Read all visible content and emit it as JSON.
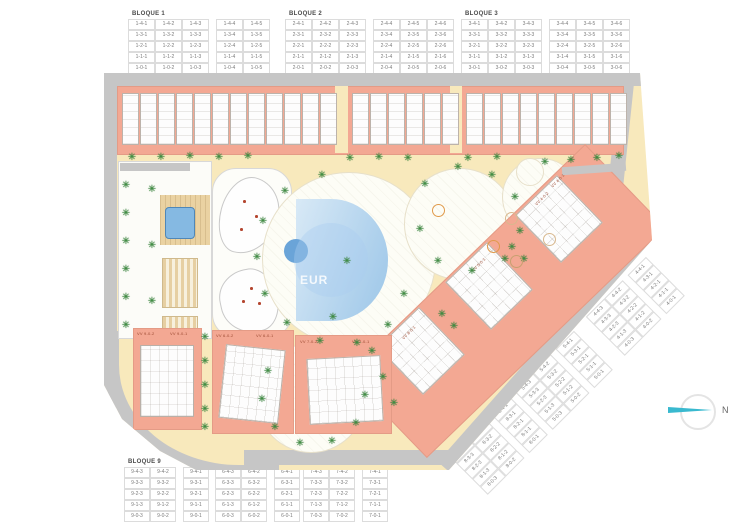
{
  "site": {
    "watermark_text": "EUR",
    "compass_label": "N",
    "villa_labels": {
      "b9_left": "VV 9-0-2",
      "b9_right": "VV 9-0-1",
      "b6_left": "VV 6-0-2",
      "b6_right": "VV 6-0-1",
      "b7_left": "VV 7-0-2",
      "b7_right": "VV 7-0-1",
      "d4_a": "VV 4-0-2",
      "d4_b": "VV 4-0-1",
      "d5": "VV 5-0-1",
      "d8": "VV 8-0-1"
    }
  },
  "tables": {
    "bloque1": {
      "title": "BLOQUE 1",
      "rows": [
        [
          "1-4-1",
          "1-4-2",
          "1-4-3",
          "1-4-4",
          "1-4-5"
        ],
        [
          "1-3-1",
          "1-3-2",
          "1-3-3",
          "1-3-4",
          "1-3-5"
        ],
        [
          "1-2-1",
          "1-2-2",
          "1-2-3",
          "1-2-4",
          "1-2-5"
        ],
        [
          "1-1-1",
          "1-1-2",
          "1-1-3",
          "1-1-4",
          "1-1-5"
        ],
        [
          "1-0-1",
          "1-0-2",
          "1-0-3",
          "1-0-4",
          "1-0-5"
        ]
      ]
    },
    "bloque2": {
      "title": "BLOQUE 2",
      "rows": [
        [
          "2-4-1",
          "2-4-2",
          "2-4-3",
          "2-4-4",
          "2-4-5",
          "2-4-6"
        ],
        [
          "2-3-1",
          "2-3-2",
          "2-3-3",
          "2-3-4",
          "2-3-5",
          "2-3-6"
        ],
        [
          "2-2-1",
          "2-2-2",
          "2-2-3",
          "2-2-4",
          "2-2-5",
          "2-2-6"
        ],
        [
          "2-1-1",
          "2-1-2",
          "2-1-3",
          "2-1-4",
          "2-1-5",
          "2-1-6"
        ],
        [
          "2-0-1",
          "2-0-2",
          "2-0-3",
          "2-0-4",
          "2-0-5",
          "2-0-6"
        ]
      ]
    },
    "bloque3": {
      "title": "BLOQUE 3",
      "rows": [
        [
          "3-4-1",
          "3-4-2",
          "3-4-3",
          "3-4-4",
          "3-4-5",
          "3-4-6"
        ],
        [
          "3-3-1",
          "3-3-2",
          "3-3-3",
          "3-3-4",
          "3-3-5",
          "3-3-6"
        ],
        [
          "3-2-1",
          "3-2-2",
          "3-2-3",
          "3-2-4",
          "3-2-5",
          "3-2-6"
        ],
        [
          "3-1-1",
          "3-1-2",
          "3-1-3",
          "3-1-4",
          "3-1-5",
          "3-1-6"
        ],
        [
          "3-0-1",
          "3-0-2",
          "3-0-3",
          "3-0-4",
          "3-0-5",
          "3-0-6"
        ]
      ]
    },
    "bloque4": {
      "title": "BLOQUE 4",
      "rows": [
        [
          "4-4-3",
          "4-4-2",
          "4-4-1"
        ],
        [
          "4-3-3",
          "4-3-2",
          "4-3-1"
        ],
        [
          "4-2-3",
          "4-2-2",
          "4-2-1"
        ],
        [
          "4-1-3",
          "4-1-2",
          "4-1-1"
        ],
        [
          "4-0-3",
          "4-0-2",
          "4-0-1"
        ]
      ]
    },
    "bloque5": {
      "title": "BLOQUE 5",
      "rows": [
        [
          "5-4-3",
          "5-4-2",
          "5-4-1"
        ],
        [
          "5-3-3",
          "5-3-2",
          "5-3-1"
        ],
        [
          "5-2-3",
          "5-2-2",
          "5-2-1"
        ],
        [
          "5-1-3",
          "5-1-2",
          "5-1-1"
        ],
        [
          "5-0-3",
          "5-0-2",
          "5-0-1"
        ]
      ]
    },
    "bloque8": {
      "title": "BLOQUE 8",
      "rows": [
        [
          "8-4-3",
          "8-4-2",
          "8-4-1"
        ],
        [
          "8-3-3",
          "8-3-2",
          "8-3-1"
        ],
        [
          "8-2-3",
          "8-2-2",
          "8-2-1"
        ],
        [
          "8-1-3",
          "8-1-2",
          "8-1-1"
        ],
        [
          "8-0-3",
          "8-0-2",
          "8-0-1"
        ]
      ]
    },
    "bloque9": {
      "title": "BLOQUE 9",
      "rows": [
        [
          "9-4-3",
          "9-4-2",
          "9-4-1"
        ],
        [
          "9-3-3",
          "9-3-2",
          "9-3-1"
        ],
        [
          "9-2-3",
          "9-2-2",
          "9-2-1"
        ],
        [
          "9-1-3",
          "9-1-2",
          "9-1-1"
        ],
        [
          "9-0-3",
          "9-0-2",
          "9-0-1"
        ]
      ]
    },
    "bloque6": {
      "title": "BLOQUE 6",
      "rows": [
        [
          "6-4-3",
          "6-4-2",
          "6-4-1"
        ],
        [
          "6-3-3",
          "6-3-2",
          "6-3-1"
        ],
        [
          "6-2-3",
          "6-2-2",
          "6-2-1"
        ],
        [
          "6-1-3",
          "6-1-2",
          "6-1-1"
        ],
        [
          "6-0-3",
          "6-0-2",
          "6-0-1"
        ]
      ]
    },
    "bloque7": {
      "title": "BLOQUE 7",
      "rows": [
        [
          "7-4-3",
          "7-4-2",
          "7-4-1"
        ],
        [
          "7-3-3",
          "7-3-2",
          "7-3-1"
        ],
        [
          "7-2-3",
          "7-2-2",
          "7-2-1"
        ],
        [
          "7-1-3",
          "7-1-2",
          "7-1-1"
        ],
        [
          "7-0-3",
          "7-0-2",
          "7-0-1"
        ]
      ]
    }
  }
}
